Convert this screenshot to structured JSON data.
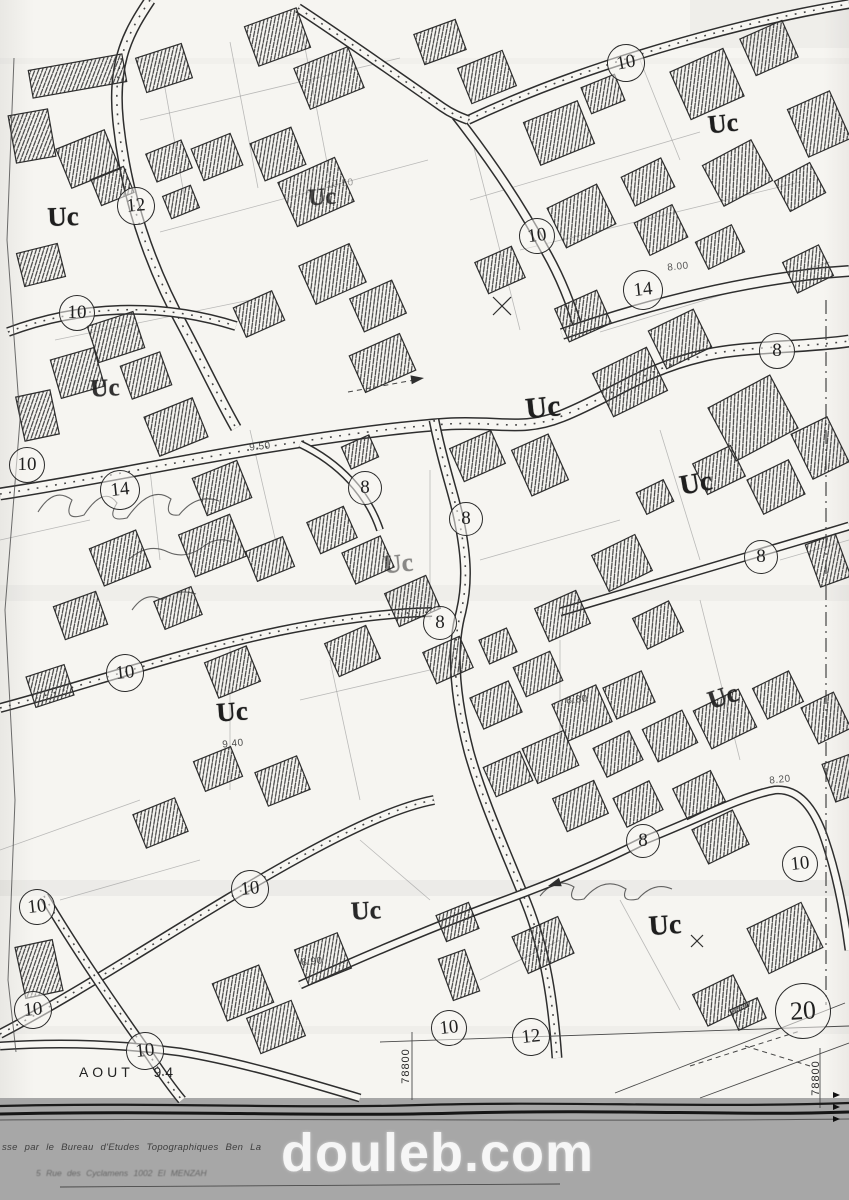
{
  "map": {
    "zone_code": "Uc",
    "zone_labels": [
      {
        "text": "Uc",
        "x": 63,
        "y": 217,
        "rot": -2,
        "o": 1,
        "s": 27
      },
      {
        "text": "Uc",
        "x": 322,
        "y": 198,
        "rot": -4,
        "o": 0.8,
        "s": 24
      },
      {
        "text": "Uc",
        "x": 723,
        "y": 124,
        "rot": -6,
        "o": 1,
        "s": 26
      },
      {
        "text": "Uc",
        "x": 105,
        "y": 389,
        "rot": -3,
        "o": 0.9,
        "s": 25
      },
      {
        "text": "Uc",
        "x": 543,
        "y": 408,
        "rot": -6,
        "o": 1,
        "s": 30
      },
      {
        "text": "Uc",
        "x": 696,
        "y": 484,
        "rot": -10,
        "o": 1,
        "s": 28
      },
      {
        "text": "Uc",
        "x": 398,
        "y": 564,
        "rot": -6,
        "o": 0.5,
        "s": 26
      },
      {
        "text": "Uc",
        "x": 232,
        "y": 712,
        "rot": -4,
        "o": 1,
        "s": 27
      },
      {
        "text": "Uc",
        "x": 723,
        "y": 697,
        "rot": -18,
        "o": 0.9,
        "s": 26
      },
      {
        "text": "Uc",
        "x": 366,
        "y": 911,
        "rot": -3,
        "o": 0.95,
        "s": 26
      },
      {
        "text": "Uc",
        "x": 665,
        "y": 926,
        "rot": -4,
        "o": 1,
        "s": 28
      }
    ],
    "road_width_badges": [
      {
        "value": "12",
        "x": 136,
        "y": 206,
        "r": 18,
        "rot": -5
      },
      {
        "value": "10",
        "x": 77,
        "y": 313,
        "r": 17,
        "rot": 0
      },
      {
        "value": "10",
        "x": 626,
        "y": 63,
        "r": 18,
        "rot": -10
      },
      {
        "value": "10",
        "x": 537,
        "y": 236,
        "r": 17,
        "rot": -8
      },
      {
        "value": "14",
        "x": 643,
        "y": 290,
        "r": 19,
        "rot": -6
      },
      {
        "value": "8",
        "x": 777,
        "y": 351,
        "r": 17,
        "rot": 0
      },
      {
        "value": "10",
        "x": 27,
        "y": 465,
        "r": 17,
        "rot": 0
      },
      {
        "value": "14",
        "x": 120,
        "y": 490,
        "r": 19,
        "rot": -6
      },
      {
        "value": "8",
        "x": 365,
        "y": 488,
        "r": 16,
        "rot": 0
      },
      {
        "value": "8",
        "x": 466,
        "y": 519,
        "r": 16,
        "rot": 0
      },
      {
        "value": "8",
        "x": 761,
        "y": 557,
        "r": 16,
        "rot": 0
      },
      {
        "value": "8",
        "x": 440,
        "y": 623,
        "r": 16,
        "rot": 0
      },
      {
        "value": "10",
        "x": 125,
        "y": 673,
        "r": 18,
        "rot": -6
      },
      {
        "value": "8",
        "x": 643,
        "y": 841,
        "r": 16,
        "rot": 0
      },
      {
        "value": "10",
        "x": 800,
        "y": 864,
        "r": 17,
        "rot": -6
      },
      {
        "value": "10",
        "x": 250,
        "y": 889,
        "r": 18,
        "rot": -6
      },
      {
        "value": "10",
        "x": 37,
        "y": 907,
        "r": 17,
        "rot": -6
      },
      {
        "value": "10",
        "x": 33,
        "y": 1010,
        "r": 18,
        "rot": -6
      },
      {
        "value": "10",
        "x": 145,
        "y": 1051,
        "r": 18,
        "rot": -6
      },
      {
        "value": "10",
        "x": 449,
        "y": 1028,
        "r": 17,
        "rot": -6
      },
      {
        "value": "12",
        "x": 531,
        "y": 1037,
        "r": 18,
        "rot": -6
      },
      {
        "value": "20",
        "x": 803,
        "y": 1011,
        "r": 27,
        "rot": -4
      }
    ],
    "elevation_marks": [
      {
        "text": "10.50",
        "x": 340,
        "y": 184,
        "o": 0.5
      },
      {
        "text": "8.00",
        "x": 678,
        "y": 267,
        "o": 0.85
      },
      {
        "text": "9.50",
        "x": 260,
        "y": 447,
        "o": 0.9
      },
      {
        "text": "9.40",
        "x": 233,
        "y": 744,
        "o": 0.9
      },
      {
        "text": "8.80",
        "x": 577,
        "y": 700,
        "o": 0.85
      },
      {
        "text": "8.20",
        "x": 780,
        "y": 780,
        "o": 0.85
      },
      {
        "text": "8.90",
        "x": 312,
        "y": 962,
        "o": 0.85
      }
    ],
    "date_note": {
      "text": "AOUT 94",
      "x": 128,
      "y": 1072
    },
    "grid_coords": [
      {
        "text": "78800",
        "x": 406,
        "y": 1066
      },
      {
        "text": "78800",
        "x": 816,
        "y": 1078
      }
    ]
  },
  "footer": {
    "credit_line1": "sse par le Bureau d'Etudes Topographiques Ben La",
    "credit_line2": "5 Rue des Cyclamens 1002 El MENZAH",
    "watermark": "douleb.com",
    "bar_color": "#a7a7a7"
  },
  "colors": {
    "paper": "#f7f6f2",
    "ink": "#2e2e2e",
    "hatch": "#3f3f3f"
  },
  "geometry": {
    "folds": [
      [
        0,
        585,
        849,
        16,
        0.05
      ],
      [
        0,
        880,
        849,
        16,
        0.07
      ],
      [
        0,
        1026,
        849,
        8,
        0.05
      ],
      [
        690,
        0,
        159,
        48,
        0.05
      ],
      [
        0,
        58,
        849,
        6,
        0.04
      ]
    ],
    "parcel_lines": [
      [
        160,
        60,
        185,
        200
      ],
      [
        230,
        42,
        258,
        188
      ],
      [
        302,
        32,
        330,
        178
      ],
      [
        140,
        120,
        400,
        58
      ],
      [
        160,
        232,
        428,
        160
      ],
      [
        470,
        132,
        520,
        330
      ],
      [
        520,
        250,
        800,
        182
      ],
      [
        600,
        332,
        830,
        262
      ],
      [
        470,
        200,
        700,
        132
      ],
      [
        640,
        60,
        680,
        160
      ],
      [
        55,
        340,
        250,
        300
      ],
      [
        0,
        540,
        90,
        520
      ],
      [
        150,
        470,
        160,
        560
      ],
      [
        250,
        430,
        280,
        560
      ],
      [
        430,
        470,
        430,
        620
      ],
      [
        480,
        560,
        620,
        520
      ],
      [
        660,
        430,
        700,
        560
      ],
      [
        230,
        640,
        230,
        790
      ],
      [
        330,
        660,
        360,
        800
      ],
      [
        560,
        640,
        560,
        760
      ],
      [
        700,
        600,
        740,
        760
      ],
      [
        0,
        850,
        140,
        800
      ],
      [
        360,
        840,
        430,
        900
      ],
      [
        620,
        900,
        680,
        1010
      ],
      [
        780,
        560,
        849,
        540
      ],
      [
        300,
        700,
        430,
        670
      ],
      [
        60,
        900,
        200,
        860
      ],
      [
        480,
        980,
        560,
        940
      ]
    ],
    "roads": [
      {
        "d": "M150,0 C130,30 112,60 118,120 C124,180 142,252 185,330 C205,368 220,400 236,428",
        "w": 12,
        "dots": 1
      },
      {
        "d": "M8,332 C80,305 160,302 236,326",
        "w": 10,
        "dots": 1
      },
      {
        "d": "M0,494 C80,482 170,463 260,448 C340,435 400,427 447,424 C500,421 522,432 562,416 C612,396 642,370 702,356 C742,346 800,348 849,341",
        "w": 13,
        "dots": 1
      },
      {
        "d": "M434,420 C444,470 456,500 460,525 C466,556 468,582 461,612 C450,652 456,702 469,752 C483,802 506,852 526,902 C546,952 553,1002 557,1058",
        "w": 11,
        "dots": 1
      },
      {
        "d": "M0,708 C80,687 180,652 280,631 C330,621 382,613 432,612",
        "w": 10,
        "dots": 1
      },
      {
        "d": "M0,1034 C90,987 200,912 300,857 C360,824 402,806 434,800",
        "w": 10,
        "dots": 1
      },
      {
        "d": "M44,896 C76,950 112,1002 150,1056 C162,1074 172,1088 182,1100",
        "w": 10,
        "dots": 1
      },
      {
        "d": "M300,985 C360,958 430,928 500,902 C560,880 610,858 645,840 C700,818 745,795 775,790 C800,788 815,810 825,840 C838,878 845,920 849,950",
        "w": 9,
        "dots": 0
      },
      {
        "d": "M468,120 C540,86 612,62 682,42 C742,25 800,12 849,4",
        "w": 10,
        "dots": 1
      },
      {
        "d": "M456,116 C492,162 522,207 546,252 C562,280 572,307 580,334",
        "w": 10,
        "dots": 0
      },
      {
        "d": "M562,334 C642,306 732,283 822,273 L849,271",
        "w": 12,
        "dots": 0
      },
      {
        "d": "M298,8 C332,30 392,72 442,107 C452,114 460,117 468,120",
        "w": 10,
        "dots": 1
      },
      {
        "d": "M560,612 C650,586 750,556 849,526",
        "w": 9,
        "dots": 0
      },
      {
        "d": "M300,444 C340,463 368,494 380,530",
        "w": 8,
        "dots": 0
      },
      {
        "d": "M0,1046 C60,1042 120,1044 180,1052 C240,1062 300,1080 360,1098",
        "w": 9,
        "dots": 0
      }
    ],
    "thin_lines": [
      [
        380,
        1042,
        849,
        1026
      ],
      [
        615,
        1093,
        845,
        1003
      ],
      [
        700,
        1098,
        849,
        1043
      ],
      [
        412,
        1032,
        412,
        1100
      ],
      [
        820,
        1048,
        820,
        1108
      ],
      [
        60,
        1187,
        560,
        1184
      ]
    ],
    "dashed_lines": [
      [
        690,
        1066,
        800,
        1031
      ],
      [
        348,
        392,
        420,
        379
      ],
      [
        745,
        1046,
        810,
        1066
      ]
    ],
    "dashdot_lines": [
      [
        826,
        300,
        826,
        1005
      ]
    ],
    "squiggles": [
      "M38,512 q16,-26 34,-12 q-10,22 12,15 q20,-30 33,-12 q-12,20 10,15 q24,-34 44,-19 q-8,18 8,16 q18,-22 40,-14",
      "M128,560 q20,-18 40,-8 q18,8 36,-6 q14,-10 28,-4",
      "M132,610 q14,-20 30,-10 q16,-12 34,-6",
      "M540,896 q16,-20 34,-9 q-8,16 10,12 q20,-24 42,-10 q-6,14 12,10 q16,-18 34,-10"
    ],
    "x_marks": [
      [
        502,
        306,
        9
      ],
      [
        697,
        941,
        6
      ]
    ],
    "arrows": [
      [
        424,
        378,
        -8
      ],
      [
        548,
        886,
        162
      ]
    ],
    "edge_marks": [
      [
        840,
        1095
      ],
      [
        840,
        1107
      ],
      [
        840,
        1119
      ]
    ],
    "sheet_edge": "14,58 7,240 20,420 5,610 15,800 8,980 16,1052",
    "footer_lines": [
      {
        "d": "M0,1106 C140,1102 300,1109 420,1105 C560,1101 700,1108 849,1103",
        "c": "#1c1c1c",
        "w": 2.2
      },
      {
        "d": "M0,1114 C160,1110 320,1117 460,1113 C620,1109 740,1116 849,1112",
        "c": "#161616",
        "w": 3
      },
      {
        "d": "M0,1120 C300,1118 600,1122 849,1119",
        "c": "#555",
        "w": 1
      }
    ],
    "buildings": [
      [
        30,
        62,
        95,
        28,
        -10
      ],
      [
        140,
        50,
        48,
        36,
        -18
      ],
      [
        250,
        16,
        55,
        42,
        -20
      ],
      [
        300,
        56,
        58,
        44,
        -22
      ],
      [
        418,
        26,
        44,
        32,
        -20
      ],
      [
        12,
        112,
        40,
        48,
        -10
      ],
      [
        62,
        138,
        52,
        42,
        -22
      ],
      [
        150,
        146,
        38,
        30,
        -22
      ],
      [
        196,
        140,
        42,
        34,
        -22
      ],
      [
        256,
        134,
        44,
        40,
        -22
      ],
      [
        285,
        168,
        62,
        48,
        -24
      ],
      [
        166,
        190,
        30,
        24,
        -22
      ],
      [
        20,
        248,
        42,
        34,
        -14
      ],
      [
        92,
        318,
        48,
        38,
        -18
      ],
      [
        238,
        298,
        42,
        32,
        -24
      ],
      [
        305,
        253,
        55,
        42,
        -24
      ],
      [
        355,
        288,
        46,
        36,
        -24
      ],
      [
        463,
        58,
        48,
        38,
        -22
      ],
      [
        530,
        110,
        58,
        46,
        -22
      ],
      [
        585,
        80,
        36,
        28,
        -22
      ],
      [
        678,
        58,
        58,
        52,
        -24
      ],
      [
        746,
        28,
        46,
        40,
        -24
      ],
      [
        796,
        98,
        46,
        52,
        -24
      ],
      [
        710,
        150,
        55,
        46,
        -28
      ],
      [
        780,
        170,
        40,
        34,
        -28
      ],
      [
        626,
        166,
        44,
        32,
        -26
      ],
      [
        554,
        194,
        55,
        44,
        -26
      ],
      [
        640,
        212,
        42,
        36,
        -26
      ],
      [
        700,
        232,
        40,
        30,
        -26
      ],
      [
        788,
        252,
        40,
        34,
        -26
      ],
      [
        480,
        253,
        40,
        34,
        -24
      ],
      [
        560,
        298,
        46,
        36,
        -24
      ],
      [
        355,
        343,
        55,
        40,
        -24
      ],
      [
        55,
        353,
        45,
        40,
        -16
      ],
      [
        125,
        358,
        42,
        35,
        -20
      ],
      [
        20,
        393,
        35,
        45,
        -12
      ],
      [
        150,
        406,
        52,
        42,
        -22
      ],
      [
        198,
        468,
        48,
        40,
        -22
      ],
      [
        95,
        538,
        50,
        40,
        -22
      ],
      [
        185,
        523,
        55,
        45,
        -22
      ],
      [
        250,
        543,
        40,
        32,
        -22
      ],
      [
        58,
        598,
        45,
        35,
        -20
      ],
      [
        158,
        593,
        40,
        30,
        -22
      ],
      [
        312,
        513,
        40,
        34,
        -24
      ],
      [
        347,
        543,
        42,
        34,
        -24
      ],
      [
        390,
        583,
        45,
        36,
        -24
      ],
      [
        455,
        438,
        45,
        36,
        -24
      ],
      [
        600,
        358,
        60,
        48,
        -26
      ],
      [
        655,
        318,
        50,
        42,
        -26
      ],
      [
        718,
        388,
        70,
        60,
        -28
      ],
      [
        698,
        453,
        42,
        34,
        -26
      ],
      [
        753,
        468,
        46,
        38,
        -26
      ],
      [
        800,
        423,
        40,
        50,
        -26
      ],
      [
        598,
        543,
        48,
        40,
        -26
      ],
      [
        812,
        538,
        32,
        45,
        -20
      ],
      [
        638,
        608,
        40,
        34,
        -26
      ],
      [
        540,
        598,
        45,
        36,
        -24
      ],
      [
        30,
        670,
        40,
        32,
        -18
      ],
      [
        210,
        653,
        45,
        38,
        -22
      ],
      [
        330,
        633,
        45,
        36,
        -24
      ],
      [
        428,
        643,
        40,
        34,
        -24
      ],
      [
        483,
        633,
        30,
        26,
        -24
      ],
      [
        198,
        753,
        40,
        32,
        -22
      ],
      [
        260,
        763,
        45,
        36,
        -22
      ],
      [
        138,
        805,
        45,
        36,
        -22
      ],
      [
        475,
        688,
        42,
        34,
        -24
      ],
      [
        518,
        658,
        40,
        32,
        -24
      ],
      [
        558,
        693,
        48,
        40,
        -24
      ],
      [
        608,
        678,
        42,
        34,
        -24
      ],
      [
        648,
        718,
        44,
        36,
        -26
      ],
      [
        598,
        738,
        40,
        32,
        -26
      ],
      [
        528,
        738,
        45,
        38,
        -24
      ],
      [
        488,
        758,
        40,
        32,
        -24
      ],
      [
        558,
        788,
        45,
        36,
        -24
      ],
      [
        618,
        788,
        40,
        32,
        -26
      ],
      [
        678,
        778,
        42,
        34,
        -26
      ],
      [
        700,
        698,
        50,
        42,
        -26
      ],
      [
        758,
        678,
        40,
        34,
        -26
      ],
      [
        808,
        698,
        36,
        40,
        -26
      ],
      [
        828,
        758,
        30,
        40,
        -20
      ],
      [
        698,
        818,
        45,
        38,
        -26
      ],
      [
        218,
        973,
        50,
        40,
        -22
      ],
      [
        252,
        1008,
        48,
        38,
        -22
      ],
      [
        518,
        925,
        50,
        40,
        -24
      ],
      [
        445,
        953,
        28,
        44,
        -20
      ],
      [
        300,
        940,
        46,
        38,
        -22
      ],
      [
        755,
        913,
        60,
        50,
        -26
      ],
      [
        698,
        983,
        45,
        35,
        -26
      ],
      [
        733,
        1003,
        30,
        22,
        -24
      ],
      [
        20,
        943,
        38,
        52,
        -12
      ],
      [
        440,
        908,
        35,
        28,
        -22
      ],
      [
        95,
        172,
        35,
        28,
        -22
      ],
      [
        345,
        440,
        30,
        24,
        -24
      ],
      [
        520,
        440,
        40,
        50,
        -24
      ],
      [
        640,
        485,
        30,
        24,
        -26
      ]
    ]
  }
}
